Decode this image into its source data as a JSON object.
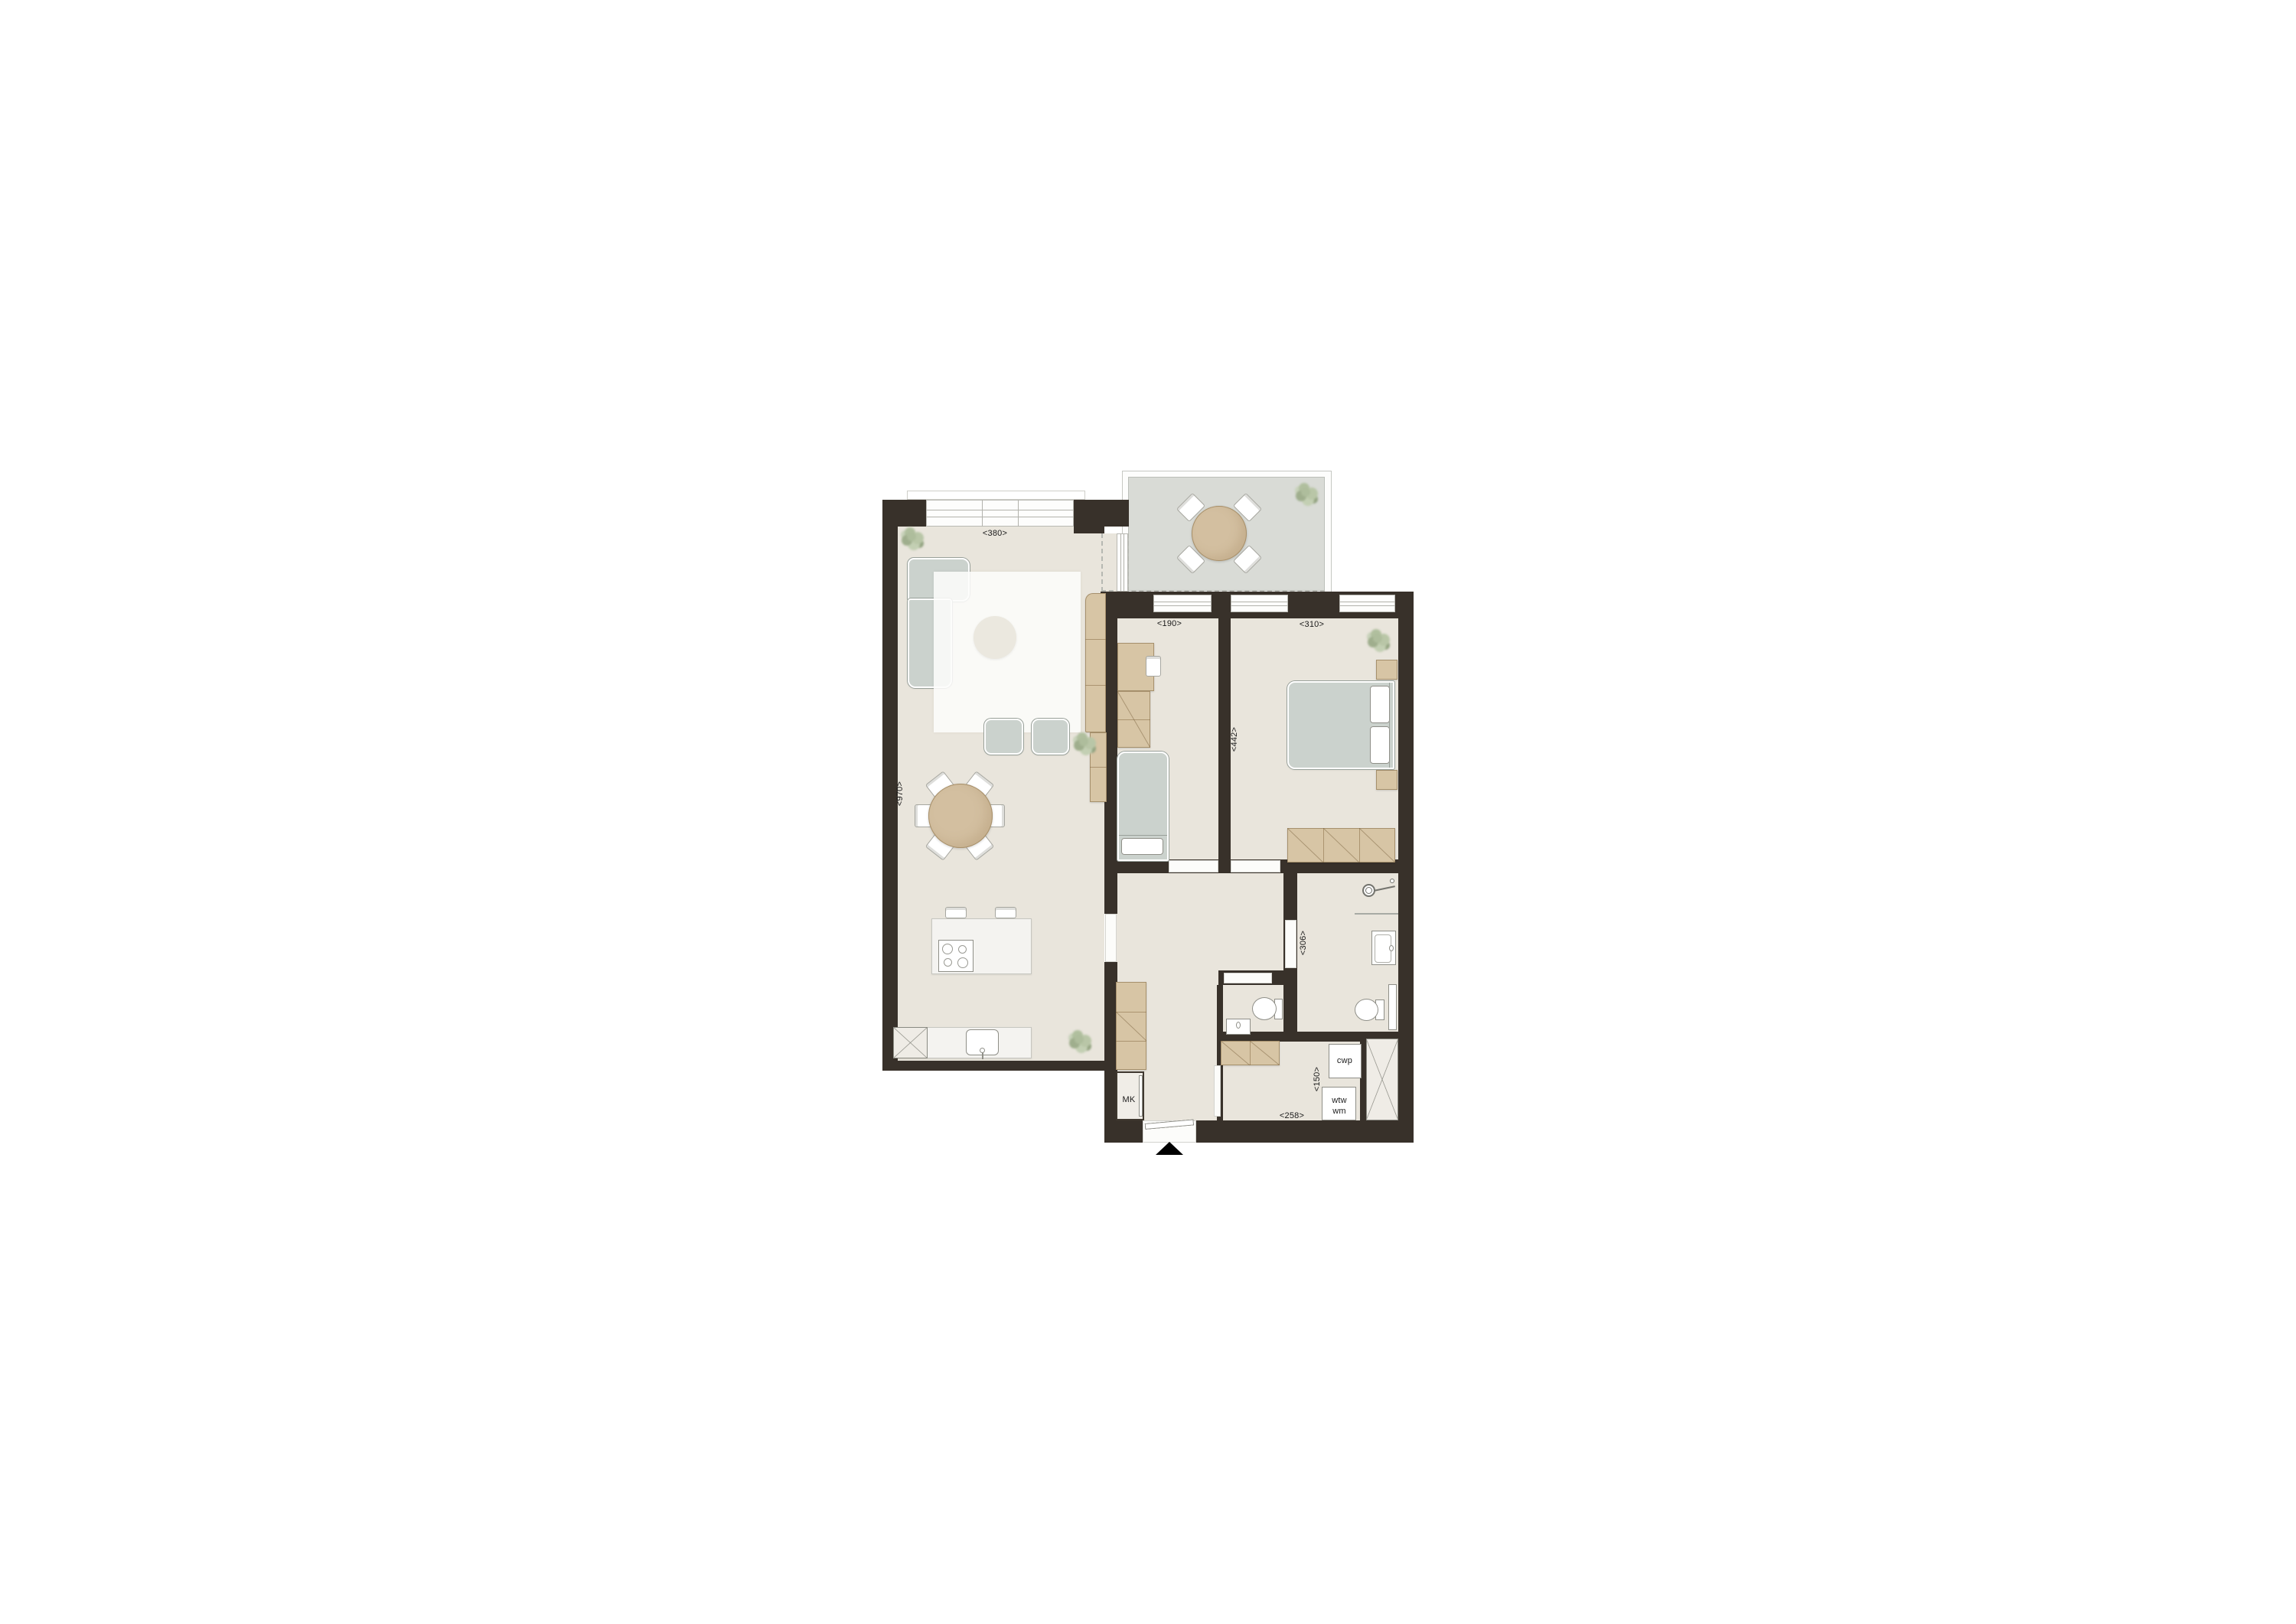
{
  "palette": {
    "wall": "#38312a",
    "floor": "#e9e5dc",
    "terrace_floor": "#d9dbd6",
    "wood": "#d7c5a5",
    "upholstery": "#cbd2cd",
    "marble": "#f4f3f0",
    "rug": "#fdfdfb",
    "dashed_line": "#b6b8b2",
    "label_color": "#1b1b1b"
  },
  "dims": {
    "living_width": "<380>",
    "living_length": "<970>",
    "bedroom2_width": "<190>",
    "bedroom1_width": "<310>",
    "bedrooms_depth": "<442>",
    "bathroom_depth": "<306>",
    "utility_width": "<150>",
    "hall_width": "<258>"
  },
  "tags": {
    "meter_closet": "MK",
    "heat_pump": "cwp",
    "heat_recovery_unit": "wtw",
    "washing_machine": "wm"
  }
}
